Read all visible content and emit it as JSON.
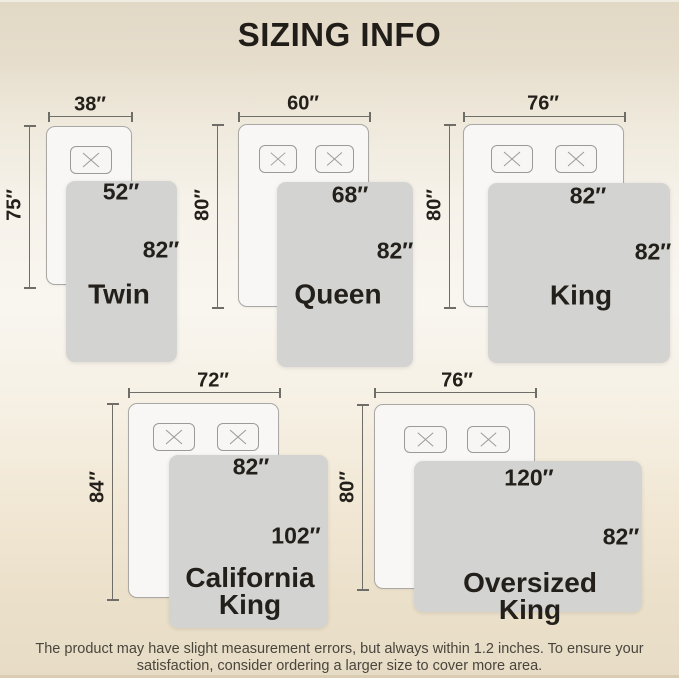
{
  "title": "SIZING INFO",
  "beds": [
    {
      "name_lines": [
        "Twin"
      ],
      "bed_width_label": "38″",
      "bed_height_label": "75″",
      "blanket_width_label": "52″",
      "blanket_height_label": "82″",
      "pillow_count": 1
    },
    {
      "name_lines": [
        "Queen"
      ],
      "bed_width_label": "60″",
      "bed_height_label": "80″",
      "blanket_width_label": "68″",
      "blanket_height_label": "82″",
      "pillow_count": 2
    },
    {
      "name_lines": [
        "King"
      ],
      "bed_width_label": "76″",
      "bed_height_label": "80″",
      "blanket_width_label": "82″",
      "blanket_height_label": "82″",
      "pillow_count": 2
    },
    {
      "name_lines": [
        "California",
        "King"
      ],
      "bed_width_label": "72″",
      "bed_height_label": "84″",
      "blanket_width_label": "82″",
      "blanket_height_label": "102″",
      "pillow_count": 2
    },
    {
      "name_lines": [
        "Oversized",
        "King"
      ],
      "bed_width_label": "76″",
      "bed_height_label": "80″",
      "blanket_width_label": "120″",
      "blanket_height_label": "82″",
      "pillow_count": 2
    }
  ],
  "footer": {
    "line1": "The product may have slight measurement errors, but always within 1.2 inches. To ensure your",
    "line2": "satisfaction, consider ordering a larger size to cover more area."
  },
  "colors": {
    "band_beige": "#e2d8c6",
    "blanket_gray": "#d3d3d2",
    "bed_white": "#f8f7f5",
    "text_dark": "#23201b"
  }
}
